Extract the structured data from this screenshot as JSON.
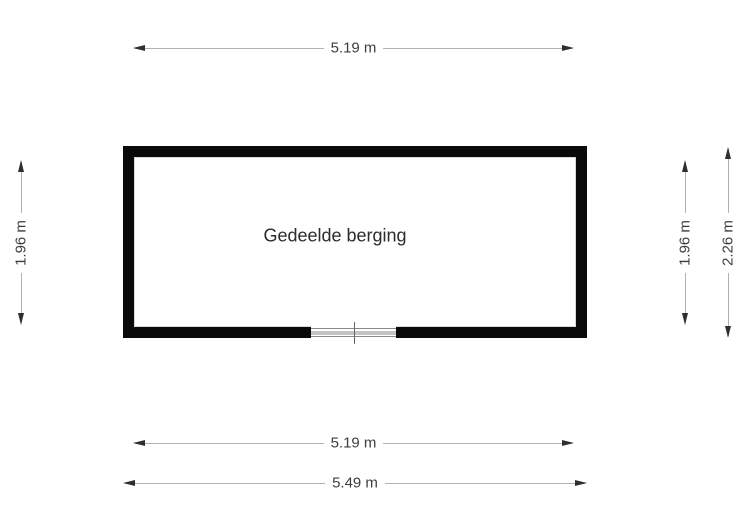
{
  "room": {
    "label": "Gedeelde berging"
  },
  "dimensions": {
    "top_width": {
      "label": "5.19 m"
    },
    "bottom_inner_width": {
      "label": "5.19 m"
    },
    "bottom_outer_width": {
      "label": "5.49 m"
    },
    "left_height": {
      "label": "1.96 m"
    },
    "right_inner_height": {
      "label": "1.96 m"
    },
    "right_outer_height": {
      "label": "2.26 m"
    }
  },
  "colors": {
    "wall": "#0a0a0a",
    "dim_line": "#b0b0b0",
    "arrow": "#2f2f2f",
    "dim_text": "#3d3d3d",
    "room_text": "#2b2b2b",
    "window_line": "#8a8a8a",
    "background": "#ffffff"
  }
}
